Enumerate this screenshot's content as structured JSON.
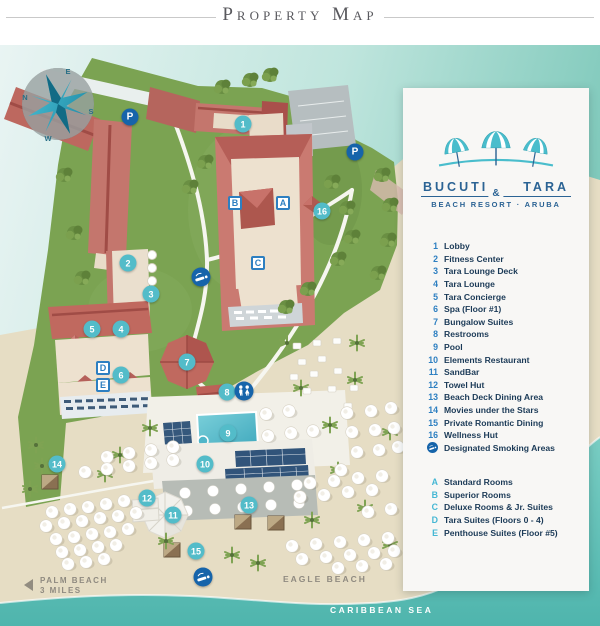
{
  "title": "Property Map",
  "legend": {
    "brand": {
      "name_left": "BUCUTI",
      "amp": "&",
      "name_right": "TARA",
      "tagline": "BEACH RESORT · ARUBA"
    },
    "numbered": [
      {
        "n": "1",
        "label": "Lobby"
      },
      {
        "n": "2",
        "label": "Fitness Center"
      },
      {
        "n": "3",
        "label": "Tara Lounge Deck"
      },
      {
        "n": "4",
        "label": "Tara Lounge"
      },
      {
        "n": "5",
        "label": "Tara Concierge"
      },
      {
        "n": "6",
        "label": "Spa (Floor #1)"
      },
      {
        "n": "7",
        "label": "Bungalow Suites"
      },
      {
        "n": "8",
        "label": "Restrooms"
      },
      {
        "n": "9",
        "label": "Pool"
      },
      {
        "n": "10",
        "label": "Elements Restaurant"
      },
      {
        "n": "11",
        "label": "SandBar"
      },
      {
        "n": "12",
        "label": "Towel Hut"
      },
      {
        "n": "13",
        "label": "Beach Deck Dining Area"
      },
      {
        "n": "14",
        "label": "Movies under the Stars"
      },
      {
        "n": "15",
        "label": "Private Romantic Dining"
      },
      {
        "n": "16",
        "label": "Wellness Hut"
      }
    ],
    "smoking_label": "Designated Smoking Areas",
    "lettered": [
      {
        "n": "A",
        "label": "Standard Rooms"
      },
      {
        "n": "B",
        "label": "Superior Rooms"
      },
      {
        "n": "C",
        "label": "Deluxe Rooms & Jr. Suites"
      },
      {
        "n": "D",
        "label": "Tara Suites (Floors 0 - 4)"
      },
      {
        "n": "E",
        "label": "Penthouse Suites (Floor #5)"
      }
    ]
  },
  "map": {
    "labels": {
      "palm_beach_line1": "PALM BEACH",
      "palm_beach_line2": "3 MILES",
      "eagle_beach": "EAGLE BEACH",
      "caribbean_sea": "CARIBBEAN SEA"
    },
    "compass": {
      "n": "N",
      "e": "E",
      "s": "S",
      "w": "W"
    },
    "parking_label": "P",
    "markers": {
      "numbers": [
        {
          "n": "1",
          "x": 243,
          "y": 124
        },
        {
          "n": "2",
          "x": 128,
          "y": 263
        },
        {
          "n": "3",
          "x": 151,
          "y": 294
        },
        {
          "n": "4",
          "x": 121,
          "y": 329
        },
        {
          "n": "5",
          "x": 92,
          "y": 329
        },
        {
          "n": "6",
          "x": 121,
          "y": 375
        },
        {
          "n": "7",
          "x": 187,
          "y": 362
        },
        {
          "n": "8",
          "x": 227,
          "y": 392
        },
        {
          "n": "9",
          "x": 228,
          "y": 433
        },
        {
          "n": "10",
          "x": 205,
          "y": 464
        },
        {
          "n": "11",
          "x": 173,
          "y": 515
        },
        {
          "n": "12",
          "x": 147,
          "y": 498
        },
        {
          "n": "13",
          "x": 249,
          "y": 505
        },
        {
          "n": "14",
          "x": 57,
          "y": 464
        },
        {
          "n": "15",
          "x": 196,
          "y": 551
        },
        {
          "n": "16",
          "x": 322,
          "y": 211
        }
      ],
      "letters": [
        {
          "n": "A",
          "x": 283,
          "y": 203
        },
        {
          "n": "B",
          "x": 235,
          "y": 203
        },
        {
          "n": "C",
          "x": 258,
          "y": 263
        },
        {
          "n": "D",
          "x": 103,
          "y": 368
        },
        {
          "n": "E",
          "x": 103,
          "y": 385
        }
      ],
      "parking": [
        {
          "x": 130,
          "y": 117
        },
        {
          "x": 355,
          "y": 152
        }
      ],
      "restroom": [
        {
          "x": 244,
          "y": 391
        }
      ],
      "smoking": [
        {
          "x": 201,
          "y": 277
        },
        {
          "x": 203,
          "y": 577
        }
      ]
    },
    "umbrellas": [
      [
        266,
        414
      ],
      [
        289,
        411
      ],
      [
        268,
        436
      ],
      [
        291,
        433
      ],
      [
        313,
        431
      ],
      [
        347,
        413
      ],
      [
        371,
        411
      ],
      [
        391,
        408
      ],
      [
        352,
        432
      ],
      [
        375,
        430
      ],
      [
        394,
        428
      ],
      [
        357,
        452
      ],
      [
        379,
        450
      ],
      [
        398,
        447
      ],
      [
        341,
        470
      ],
      [
        107,
        457
      ],
      [
        129,
        453
      ],
      [
        151,
        450
      ],
      [
        173,
        447
      ],
      [
        85,
        472
      ],
      [
        107,
        469
      ],
      [
        129,
        466
      ],
      [
        151,
        463
      ],
      [
        173,
        460
      ],
      [
        52,
        512
      ],
      [
        70,
        509
      ],
      [
        88,
        507
      ],
      [
        106,
        504
      ],
      [
        124,
        501
      ],
      [
        46,
        526
      ],
      [
        64,
        523
      ],
      [
        82,
        521
      ],
      [
        100,
        518
      ],
      [
        118,
        516
      ],
      [
        136,
        513
      ],
      [
        56,
        539
      ],
      [
        74,
        537
      ],
      [
        92,
        534
      ],
      [
        110,
        532
      ],
      [
        128,
        529
      ],
      [
        62,
        552
      ],
      [
        80,
        550
      ],
      [
        98,
        547
      ],
      [
        116,
        545
      ],
      [
        68,
        564
      ],
      [
        86,
        562
      ],
      [
        104,
        559
      ],
      [
        310,
        483
      ],
      [
        334,
        481
      ],
      [
        358,
        478
      ],
      [
        382,
        476
      ],
      [
        300,
        497
      ],
      [
        324,
        495
      ],
      [
        348,
        492
      ],
      [
        372,
        490
      ],
      [
        391,
        509
      ],
      [
        368,
        512
      ],
      [
        292,
        546
      ],
      [
        316,
        544
      ],
      [
        340,
        542
      ],
      [
        364,
        540
      ],
      [
        388,
        538
      ],
      [
        302,
        559
      ],
      [
        326,
        557
      ],
      [
        350,
        555
      ],
      [
        374,
        553
      ],
      [
        394,
        551
      ],
      [
        338,
        568
      ],
      [
        362,
        566
      ],
      [
        386,
        564
      ]
    ],
    "chairs": [
      [
        297,
        346
      ],
      [
        317,
        343
      ],
      [
        337,
        341
      ],
      [
        302,
        362
      ],
      [
        322,
        359
      ],
      [
        294,
        377
      ],
      [
        314,
        374
      ],
      [
        338,
        371
      ],
      [
        307,
        391
      ],
      [
        332,
        389
      ],
      [
        354,
        388
      ],
      [
        348,
        406
      ]
    ],
    "palms": [
      [
        150,
        428
      ],
      [
        301,
        388
      ],
      [
        330,
        425
      ],
      [
        357,
        343
      ],
      [
        287,
        343
      ],
      [
        390,
        432
      ],
      [
        365,
        508
      ],
      [
        258,
        563
      ],
      [
        232,
        555
      ],
      [
        166,
        541
      ],
      [
        105,
        474
      ],
      [
        338,
        470
      ],
      [
        390,
        545
      ],
      [
        36,
        445
      ],
      [
        42,
        466
      ],
      [
        30,
        489
      ],
      [
        312,
        520
      ],
      [
        355,
        380
      ],
      [
        120,
        455
      ]
    ],
    "trees": [
      [
        205,
        162
      ],
      [
        190,
        187
      ],
      [
        64,
        175
      ],
      [
        74,
        233
      ],
      [
        82,
        278
      ],
      [
        332,
        182
      ],
      [
        347,
        208
      ],
      [
        352,
        237
      ],
      [
        338,
        259
      ],
      [
        308,
        289
      ],
      [
        286,
        307
      ],
      [
        250,
        80
      ],
      [
        222,
        87
      ],
      [
        270,
        75
      ],
      [
        382,
        175
      ],
      [
        390,
        205
      ],
      [
        388,
        240
      ],
      [
        378,
        273
      ]
    ],
    "palapas": [
      [
        50,
        482
      ],
      [
        243,
        522
      ],
      [
        276,
        523
      ],
      [
        172,
        550
      ]
    ],
    "colors": {
      "accent_teal": "#53bcc9",
      "marker_blue": "#2d7fc1",
      "navy": "#1664aa",
      "legend_text": "#1b3a57",
      "letter_cyan": "#45b7d4",
      "brand_blue": "#2b6394",
      "grass": "#7ba352",
      "sand": "#e6ddc4",
      "sea": "#5fc0b7",
      "roof": "#c4766d"
    }
  }
}
